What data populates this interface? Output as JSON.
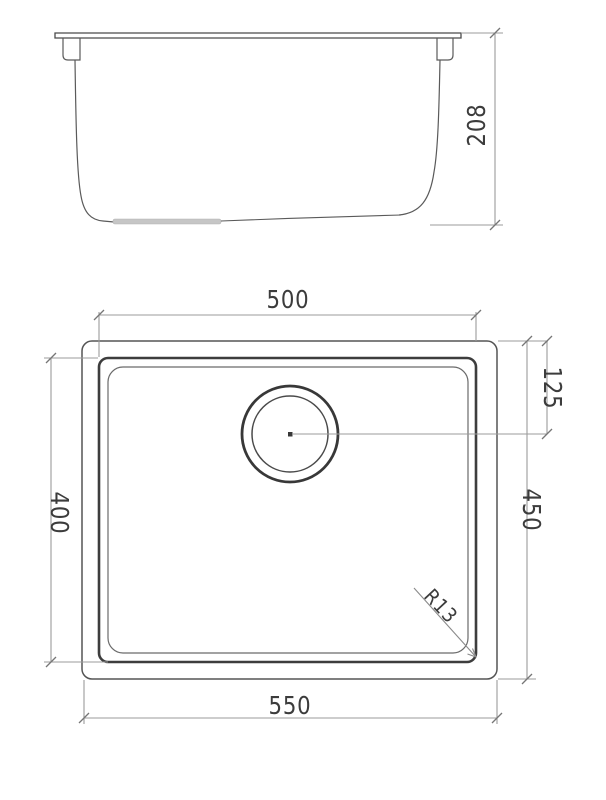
{
  "drawing": {
    "views": {
      "side_view": "sink side elevation",
      "plan_view": "sink plan view"
    },
    "labels": {
      "side_height": "208",
      "bowl_width": "500",
      "bowl_depth": "400",
      "overall_width": "550",
      "overall_depth": "450",
      "drain_offset": "125",
      "corner_radius": "R13"
    },
    "colors": {
      "object_line": "#4a4a4a",
      "bold_line": "#3d3d3d",
      "dimension_line": "#9b9b9b",
      "text": "#3c3c3c",
      "drain_strip": "#c6c6c6",
      "background": "#ffffff"
    }
  }
}
